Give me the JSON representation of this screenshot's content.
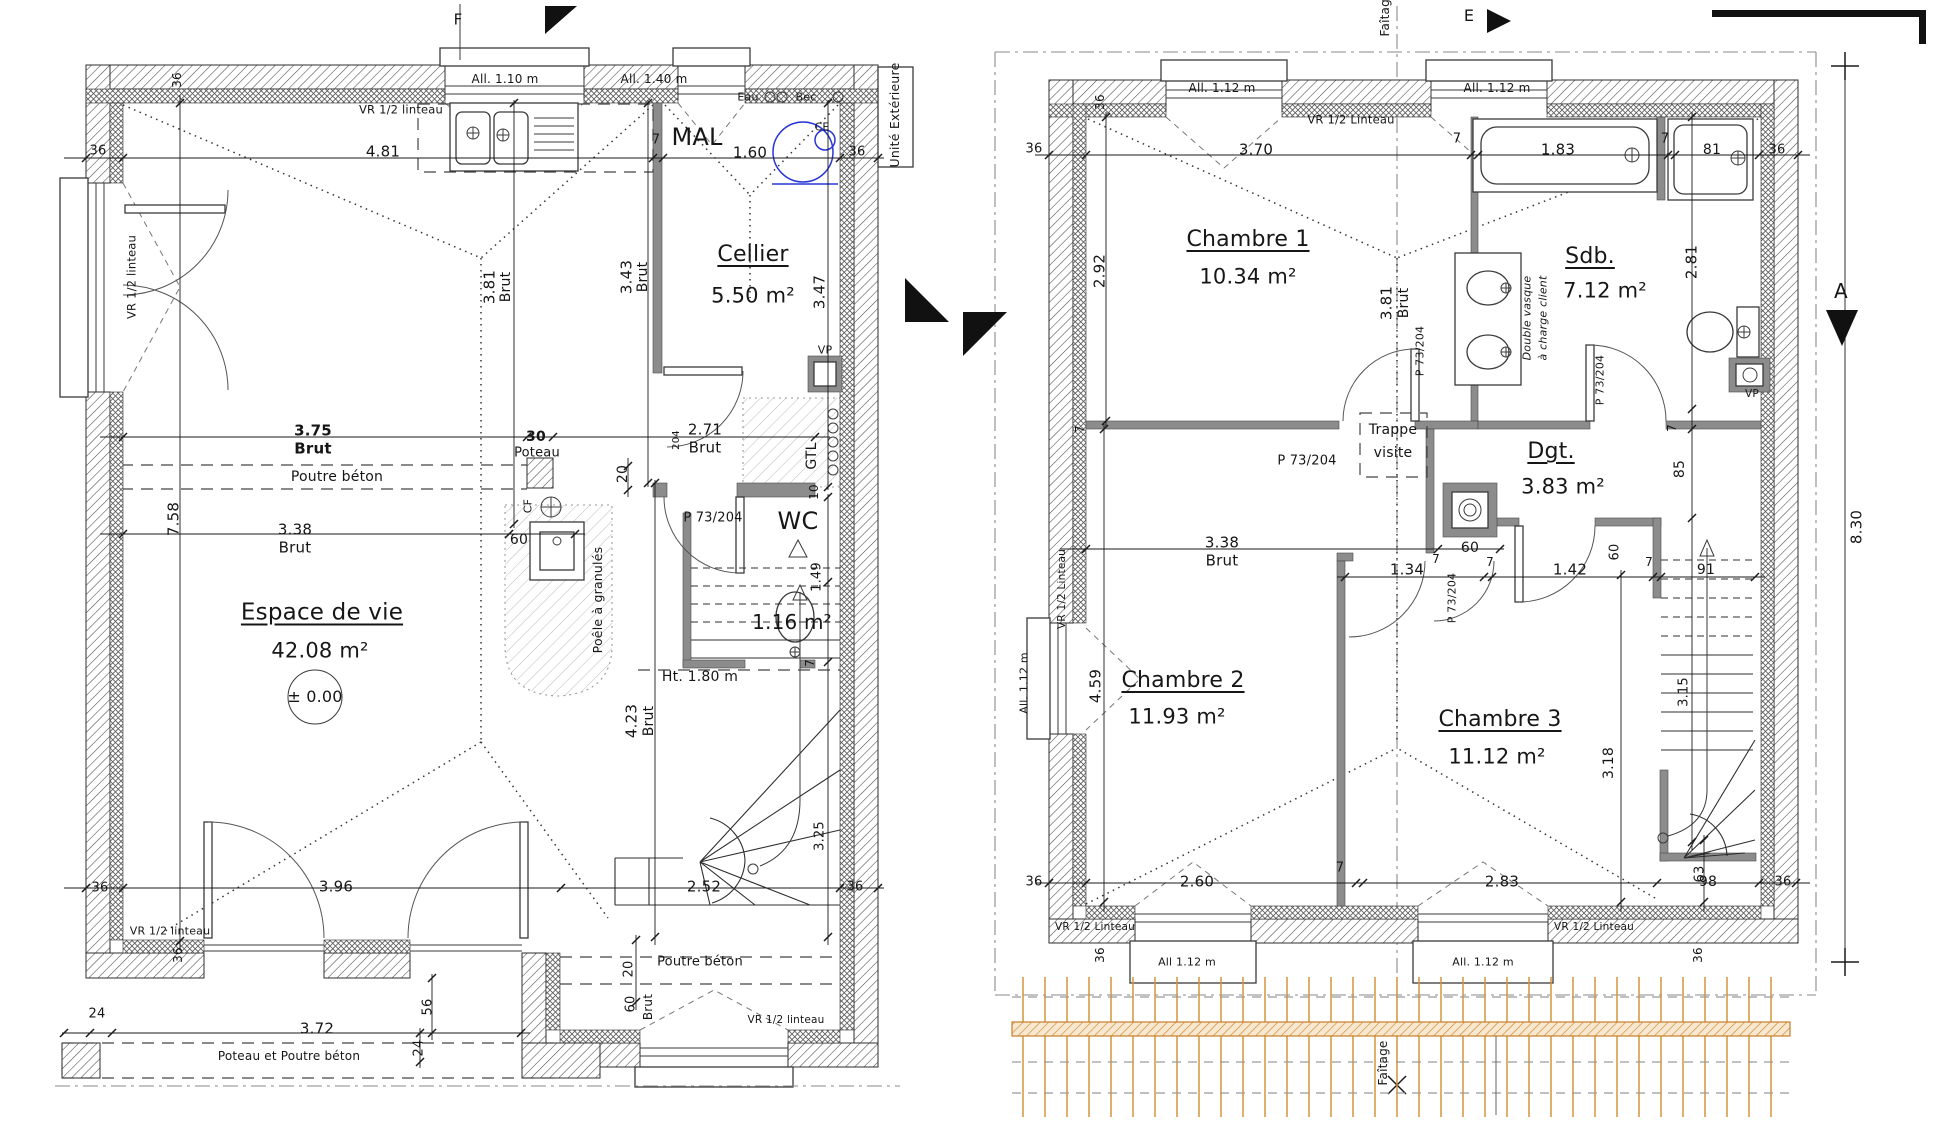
{
  "drawing": {
    "type": "architectural floor plans",
    "ground_floor": {
      "level_mark": "± 0.00",
      "rooms": [
        {
          "name": "Espace de vie",
          "area": "42.08 m²"
        },
        {
          "name": "Cellier",
          "area": "5.50 m²"
        },
        {
          "name": "WC",
          "area": "1.16 m²"
        }
      ]
    },
    "upper_floor": {
      "rooms": [
        {
          "name": "Chambre 1",
          "area": "10.34 m²"
        },
        {
          "name": "Sdb.",
          "area": "7.12 m²"
        },
        {
          "name": "Dgt.",
          "area": "3.83 m²"
        },
        {
          "name": "Chambre 2",
          "area": "11.93 m²"
        },
        {
          "name": "Chambre 3",
          "area": "11.12 m²"
        }
      ]
    },
    "colors": {
      "partition": "#8c8c8c",
      "water_heater_blue": "#2936d6",
      "roof_grid_orange": "#d3953f",
      "text": "#161616"
    }
  },
  "labels": [
    {
      "n": "section-mark-f",
      "t": "F",
      "x": 458,
      "y": 20,
      "s": 15
    },
    {
      "n": "window-note",
      "t": "All. 1.10 m",
      "x": 505,
      "y": 79,
      "s": 12
    },
    {
      "n": "window-note",
      "t": "All. 1.40 m",
      "x": 654,
      "y": 79,
      "s": 12
    },
    {
      "n": "lintel-note",
      "t": "VR 1/2 linteau",
      "x": 401,
      "y": 110,
      "s": 11.5
    },
    {
      "n": "dim",
      "t": "36",
      "x": 98,
      "y": 151,
      "s": 13
    },
    {
      "n": "dim",
      "t": "4.81",
      "x": 383,
      "y": 152,
      "s": 15
    },
    {
      "n": "dim",
      "t": "7",
      "x": 656,
      "y": 140,
      "s": 13
    },
    {
      "n": "dim",
      "t": "1.60",
      "x": 750,
      "y": 153,
      "s": 15
    },
    {
      "n": "dim",
      "t": "36",
      "x": 857,
      "y": 152,
      "s": 13
    },
    {
      "n": "dim",
      "t": "36",
      "x": 177,
      "y": 80,
      "s": 12,
      "r": 1
    },
    {
      "n": "appliance-mal",
      "t": "MAL",
      "x": 697,
      "y": 137,
      "s": 24
    },
    {
      "n": "note-eau",
      "t": "Eau",
      "x": 748,
      "y": 97,
      "s": 11
    },
    {
      "n": "note-bec",
      "t": "Bec",
      "x": 806,
      "y": 97,
      "s": 11
    },
    {
      "n": "note-ce",
      "t": "CE",
      "x": 822,
      "y": 127,
      "s": 11
    },
    {
      "n": "note-unite-exterieure",
      "t": "Unité Extérieure",
      "x": 895,
      "y": 115,
      "s": 12.5,
      "r": 1
    },
    {
      "n": "lintel-note",
      "t": "VR 1/2 linteau",
      "x": 132,
      "y": 277,
      "s": 11.5,
      "r": 1
    },
    {
      "n": "dim",
      "t": "3.81",
      "x": 490,
      "y": 287,
      "s": 15,
      "r": 1
    },
    {
      "n": "dim",
      "t": "Brut",
      "x": 506,
      "y": 287,
      "s": 14,
      "r": 1
    },
    {
      "n": "dim",
      "t": "3.43",
      "x": 627,
      "y": 277,
      "s": 15,
      "r": 1
    },
    {
      "n": "dim",
      "t": "Brut",
      "x": 643,
      "y": 277,
      "s": 14,
      "r": 1
    },
    {
      "n": "dim",
      "t": "3.47",
      "x": 820,
      "y": 292,
      "s": 15,
      "r": 1
    },
    {
      "n": "room-cellier",
      "t": "Cellier",
      "x": 753,
      "y": 255,
      "s": 22,
      "u": 1
    },
    {
      "n": "room-cellier-area",
      "t": "5.50 m²",
      "x": 753,
      "y": 296,
      "s": 21
    },
    {
      "n": "dim",
      "t": "3.75",
      "x": 313,
      "y": 431,
      "s": 15,
      "b": 1
    },
    {
      "n": "dim",
      "t": "Brut",
      "x": 313,
      "y": 449,
      "s": 15,
      "b": 1
    },
    {
      "n": "dim",
      "t": "30",
      "x": 536,
      "y": 437,
      "s": 14,
      "b": 1
    },
    {
      "n": "note-poteau",
      "t": "Poteau",
      "x": 537,
      "y": 453,
      "s": 13
    },
    {
      "n": "dim",
      "t": "2.71",
      "x": 705,
      "y": 430,
      "s": 15
    },
    {
      "n": "dim",
      "t": "Brut",
      "x": 705,
      "y": 448,
      "s": 15
    },
    {
      "n": "door-tag",
      "t": "204",
      "x": 677,
      "y": 440,
      "s": 10,
      "r": 1
    },
    {
      "n": "note-poutre-beton",
      "t": "Poutre béton",
      "x": 337,
      "y": 477,
      "s": 14
    },
    {
      "n": "dim",
      "t": "20",
      "x": 623,
      "y": 474,
      "s": 14,
      "r": 1
    },
    {
      "n": "note-vp",
      "t": "VP",
      "x": 825,
      "y": 350,
      "s": 11
    },
    {
      "n": "note-gtl",
      "t": "GTL",
      "x": 812,
      "y": 456,
      "s": 14,
      "r": 1
    },
    {
      "n": "dim",
      "t": "10",
      "x": 814,
      "y": 492,
      "s": 12,
      "r": 1
    },
    {
      "n": "door-tag",
      "t": "P 73/204",
      "x": 713,
      "y": 518,
      "s": 13
    },
    {
      "n": "room-wc",
      "t": "WC",
      "x": 798,
      "y": 521,
      "s": 24
    },
    {
      "n": "note-cf",
      "t": "CF",
      "x": 528,
      "y": 506,
      "s": 11,
      "r": 1
    },
    {
      "n": "dim",
      "t": "60",
      "x": 519,
      "y": 540,
      "s": 14
    },
    {
      "n": "dim",
      "t": "3.38",
      "x": 295,
      "y": 530,
      "s": 15
    },
    {
      "n": "dim",
      "t": "Brut",
      "x": 295,
      "y": 548,
      "s": 15
    },
    {
      "n": "dim",
      "t": "7.58",
      "x": 174,
      "y": 519,
      "s": 15,
      "r": 1
    },
    {
      "n": "note-poele",
      "t": "Poêle à granulés",
      "x": 598,
      "y": 600,
      "s": 12.5,
      "r": 1
    },
    {
      "n": "room-espace-de-vie",
      "t": "Espace de vie",
      "x": 322,
      "y": 613,
      "s": 23,
      "u": 1
    },
    {
      "n": "room-espace-de-vie-area",
      "t": "42.08 m²",
      "x": 320,
      "y": 651,
      "s": 21
    },
    {
      "n": "level-mark",
      "t": "± 0.00",
      "x": 315,
      "y": 697,
      "s": 16
    },
    {
      "n": "dim",
      "t": "1.49",
      "x": 817,
      "y": 577,
      "s": 13,
      "r": 1
    },
    {
      "n": "room-wc-area",
      "t": "1.16 m²",
      "x": 792,
      "y": 622,
      "s": 20
    },
    {
      "n": "note-height",
      "t": "Ht. 1.80 m",
      "x": 700,
      "y": 677,
      "s": 14
    },
    {
      "n": "dim",
      "t": "4.23",
      "x": 632,
      "y": 721,
      "s": 15,
      "r": 1
    },
    {
      "n": "dim",
      "t": "Brut",
      "x": 649,
      "y": 721,
      "s": 14,
      "r": 1
    },
    {
      "n": "dim",
      "t": "7",
      "x": 810,
      "y": 663,
      "s": 12,
      "r": 1
    },
    {
      "n": "dim",
      "t": "3.25",
      "x": 820,
      "y": 836,
      "s": 13,
      "r": 1
    },
    {
      "n": "dim",
      "t": "36",
      "x": 100,
      "y": 888,
      "s": 13
    },
    {
      "n": "dim",
      "t": "3.96",
      "x": 336,
      "y": 887,
      "s": 15
    },
    {
      "n": "dim",
      "t": "2.52",
      "x": 704,
      "y": 887,
      "s": 15
    },
    {
      "n": "dim",
      "t": "36",
      "x": 855,
      "y": 887,
      "s": 13
    },
    {
      "n": "lintel-note",
      "t": "VR 1/2 linteau",
      "x": 170,
      "y": 931,
      "s": 11
    },
    {
      "n": "dim",
      "t": "36",
      "x": 178,
      "y": 955,
      "s": 12,
      "r": 1
    },
    {
      "n": "dim",
      "t": "20",
      "x": 629,
      "y": 969,
      "s": 13,
      "r": 1
    },
    {
      "n": "note-poutre-beton",
      "t": "Poutre béton",
      "x": 700,
      "y": 962,
      "s": 13
    },
    {
      "n": "dim",
      "t": "60",
      "x": 631,
      "y": 1004,
      "s": 13,
      "r": 1
    },
    {
      "n": "dim",
      "t": "Brut",
      "x": 648,
      "y": 1007,
      "s": 12,
      "r": 1
    },
    {
      "n": "lintel-note",
      "t": "VR 1/2 linteau",
      "x": 786,
      "y": 1020,
      "s": 10.5
    },
    {
      "n": "dim",
      "t": "24",
      "x": 97,
      "y": 1014,
      "s": 13
    },
    {
      "n": "dim",
      "t": "3.72",
      "x": 317,
      "y": 1029,
      "s": 15
    },
    {
      "n": "dim",
      "t": "56",
      "x": 428,
      "y": 1007,
      "s": 13,
      "r": 1
    },
    {
      "n": "dim",
      "t": "24",
      "x": 419,
      "y": 1048,
      "s": 13,
      "r": 1
    },
    {
      "n": "note-poteau-poutre",
      "t": "Poteau et Poutre béton",
      "x": 289,
      "y": 1056,
      "s": 12
    },
    {
      "n": "axis-faitage",
      "t": "Faîtage",
      "x": 1385,
      "y": 14,
      "s": 12,
      "r": 1
    },
    {
      "n": "section-mark-e",
      "t": "E",
      "x": 1469,
      "y": 16,
      "s": 16
    },
    {
      "n": "window-note",
      "t": "All. 1.12 m",
      "x": 1222,
      "y": 88,
      "s": 12
    },
    {
      "n": "window-note",
      "t": "All. 1.12 m",
      "x": 1497,
      "y": 88,
      "s": 12
    },
    {
      "n": "lintel-note",
      "t": "VR 1/2 Linteau",
      "x": 1351,
      "y": 120,
      "s": 11.5
    },
    {
      "n": "dim",
      "t": "36",
      "x": 1100,
      "y": 102,
      "s": 12,
      "r": 1
    },
    {
      "n": "dim",
      "t": "36",
      "x": 1034,
      "y": 149,
      "s": 13
    },
    {
      "n": "dim",
      "t": "3.70",
      "x": 1256,
      "y": 150,
      "s": 15
    },
    {
      "n": "dim",
      "t": "7",
      "x": 1457,
      "y": 139,
      "s": 13
    },
    {
      "n": "dim",
      "t": "1.83",
      "x": 1558,
      "y": 150,
      "s": 15
    },
    {
      "n": "dim",
      "t": "7",
      "x": 1665,
      "y": 139,
      "s": 13
    },
    {
      "n": "dim",
      "t": "81",
      "x": 1712,
      "y": 150,
      "s": 14
    },
    {
      "n": "dim",
      "t": "36",
      "x": 1777,
      "y": 150,
      "s": 13
    },
    {
      "n": "room-chambre1",
      "t": "Chambre 1",
      "x": 1248,
      "y": 240,
      "s": 22,
      "u": 1
    },
    {
      "n": "room-chambre1-area",
      "t": "10.34 m²",
      "x": 1248,
      "y": 277,
      "s": 21
    },
    {
      "n": "dim",
      "t": "2.92",
      "x": 1100,
      "y": 271,
      "s": 15,
      "r": 1
    },
    {
      "n": "dim",
      "t": "3.81",
      "x": 1387,
      "y": 303,
      "s": 15,
      "r": 1
    },
    {
      "n": "dim",
      "t": "Brut",
      "x": 1404,
      "y": 303,
      "s": 14,
      "r": 1
    },
    {
      "n": "room-sdb",
      "t": "Sdb.",
      "x": 1590,
      "y": 257,
      "s": 22,
      "u": 1
    },
    {
      "n": "room-sdb-area",
      "t": "7.12 m²",
      "x": 1605,
      "y": 291,
      "s": 21
    },
    {
      "n": "dim",
      "t": "2.81",
      "x": 1692,
      "y": 262,
      "s": 15,
      "r": 1
    },
    {
      "n": "note-vasque1",
      "t": "Double vasque",
      "x": 1527,
      "y": 318,
      "s": 11,
      "r": 1,
      "i": 1
    },
    {
      "n": "note-vasque2",
      "t": "à charge client",
      "x": 1543,
      "y": 318,
      "s": 11,
      "r": 1,
      "i": 1
    },
    {
      "n": "door-tag",
      "t": "P 73/204",
      "x": 1600,
      "y": 380,
      "s": 11,
      "r": 1
    },
    {
      "n": "note-vp",
      "t": "VP",
      "x": 1752,
      "y": 394,
      "s": 10.5
    },
    {
      "n": "door-tag",
      "t": "P 73/204",
      "x": 1420,
      "y": 351,
      "s": 11,
      "r": 1
    },
    {
      "n": "dim",
      "t": "7",
      "x": 1080,
      "y": 429,
      "s": 12,
      "r": 1
    },
    {
      "n": "note-trappe1",
      "t": "Trappe",
      "x": 1393,
      "y": 430,
      "s": 14
    },
    {
      "n": "note-trappe2",
      "t": "visite",
      "x": 1393,
      "y": 453,
      "s": 14
    },
    {
      "n": "door-tag",
      "t": "P 73/204",
      "x": 1307,
      "y": 461,
      "s": 13
    },
    {
      "n": "room-dgt",
      "t": "Dgt.",
      "x": 1551,
      "y": 452,
      "s": 22,
      "u": 1
    },
    {
      "n": "room-dgt-area",
      "t": "3.83 m²",
      "x": 1563,
      "y": 487,
      "s": 21
    },
    {
      "n": "dim",
      "t": "85",
      "x": 1680,
      "y": 469,
      "s": 14,
      "r": 1
    },
    {
      "n": "dim",
      "t": "7",
      "x": 1672,
      "y": 428,
      "s": 12,
      "r": 1
    },
    {
      "n": "dim",
      "t": "3.38",
      "x": 1222,
      "y": 543,
      "s": 15
    },
    {
      "n": "dim",
      "t": "Brut",
      "x": 1222,
      "y": 561,
      "s": 15
    },
    {
      "n": "dim",
      "t": "60",
      "x": 1470,
      "y": 548,
      "s": 14
    },
    {
      "n": "dim",
      "t": "7",
      "x": 1436,
      "y": 559,
      "s": 12
    },
    {
      "n": "dim",
      "t": "1.34",
      "x": 1407,
      "y": 570,
      "s": 15
    },
    {
      "n": "door-tag",
      "t": "P 73/204",
      "x": 1452,
      "y": 598,
      "s": 11,
      "r": 1
    },
    {
      "n": "dim",
      "t": "7",
      "x": 1490,
      "y": 562,
      "s": 12
    },
    {
      "n": "dim",
      "t": "1.42",
      "x": 1570,
      "y": 570,
      "s": 15
    },
    {
      "n": "dim",
      "t": "60",
      "x": 1615,
      "y": 552,
      "s": 13,
      "r": 1
    },
    {
      "n": "dim",
      "t": "7",
      "x": 1649,
      "y": 562,
      "s": 12
    },
    {
      "n": "dim",
      "t": "91",
      "x": 1706,
      "y": 570,
      "s": 14
    },
    {
      "n": "room-chambre2",
      "t": "Chambre 2",
      "x": 1183,
      "y": 681,
      "s": 22,
      "u": 1
    },
    {
      "n": "room-chambre2-area",
      "t": "11.93 m²",
      "x": 1177,
      "y": 717,
      "s": 21
    },
    {
      "n": "dim",
      "t": "4.59",
      "x": 1096,
      "y": 686,
      "s": 15,
      "r": 1
    },
    {
      "n": "room-chambre3",
      "t": "Chambre 3",
      "x": 1500,
      "y": 720,
      "s": 22,
      "u": 1
    },
    {
      "n": "room-chambre3-area",
      "t": "11.12 m²",
      "x": 1497,
      "y": 757,
      "s": 21
    },
    {
      "n": "dim",
      "t": "3.15",
      "x": 1684,
      "y": 692,
      "s": 13,
      "r": 1
    },
    {
      "n": "dim",
      "t": "3.18",
      "x": 1609,
      "y": 763,
      "s": 14,
      "r": 1
    },
    {
      "n": "window-note",
      "t": "All. 1.12 m",
      "x": 1024,
      "y": 683,
      "s": 11,
      "r": 1
    },
    {
      "n": "lintel-note",
      "t": "VR 1/2 Linteau",
      "x": 1062,
      "y": 589,
      "s": 10.5,
      "r": 1
    },
    {
      "n": "dim",
      "t": "36",
      "x": 1034,
      "y": 882,
      "s": 13
    },
    {
      "n": "dim",
      "t": "2.60",
      "x": 1197,
      "y": 882,
      "s": 15
    },
    {
      "n": "dim",
      "t": "7",
      "x": 1340,
      "y": 868,
      "s": 13
    },
    {
      "n": "dim",
      "t": "2.83",
      "x": 1502,
      "y": 882,
      "s": 15
    },
    {
      "n": "dim",
      "t": "98",
      "x": 1708,
      "y": 882,
      "s": 14
    },
    {
      "n": "dim",
      "t": "36",
      "x": 1783,
      "y": 882,
      "s": 13
    },
    {
      "n": "dim",
      "t": "63",
      "x": 1700,
      "y": 874,
      "s": 13,
      "r": 1
    },
    {
      "n": "lintel-note",
      "t": "VR 1/2 Linteau",
      "x": 1095,
      "y": 927,
      "s": 10.5
    },
    {
      "n": "lintel-note",
      "t": "VR 1/2 Linteau",
      "x": 1594,
      "y": 927,
      "s": 10.5
    },
    {
      "n": "dim",
      "t": "36",
      "x": 1100,
      "y": 955,
      "s": 12,
      "r": 1
    },
    {
      "n": "dim",
      "t": "36",
      "x": 1698,
      "y": 955,
      "s": 12,
      "r": 1
    },
    {
      "n": "window-note",
      "t": "All 1.12 m",
      "x": 1187,
      "y": 962,
      "s": 11
    },
    {
      "n": "window-note",
      "t": "All. 1.12 m",
      "x": 1483,
      "y": 962,
      "s": 11
    },
    {
      "n": "axis-faitage",
      "t": "Faîtage",
      "x": 1383,
      "y": 1063,
      "s": 12,
      "r": 1
    },
    {
      "n": "section-mark-a",
      "t": "A",
      "x": 1841,
      "y": 291,
      "s": 20
    },
    {
      "n": "dim",
      "t": "8.30",
      "x": 1857,
      "y": 527,
      "s": 15,
      "r": 1
    }
  ]
}
